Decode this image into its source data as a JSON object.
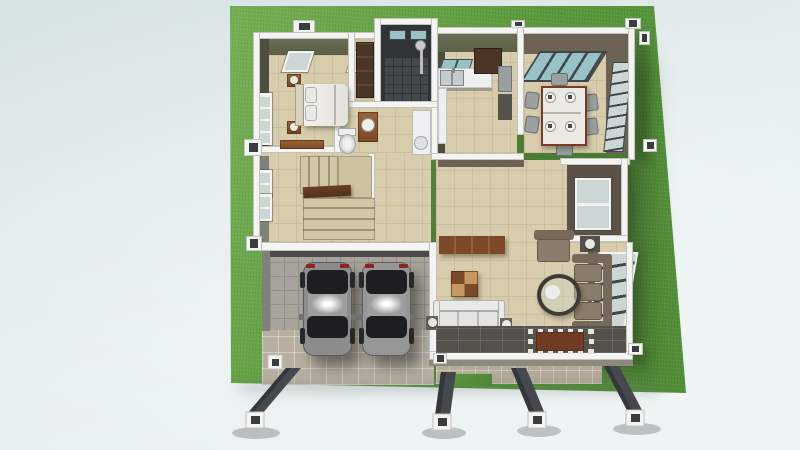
{
  "scene": {
    "type": "3d-floorplan-render",
    "view": "top-down",
    "rooms": [
      "master-bedroom",
      "walk-in-closet",
      "shower-room",
      "bathroom",
      "kitchen",
      "dining-room",
      "living-room",
      "hallway-stairs",
      "garage",
      "entry-terrace",
      "front-porch"
    ],
    "furniture": [
      "double-bed",
      "pillows",
      "headboard",
      "nightstand",
      "table-lamp",
      "bedroom-bench",
      "wardrobe",
      "toilet",
      "wood-vanity",
      "white-vanity",
      "kitchen-counter",
      "double-sink",
      "refrigerator",
      "wall-cabinet",
      "dining-table",
      "dining-chairs",
      "place-settings",
      "tv-console",
      "cubby-table",
      "white-loveseat",
      "armchair",
      "long-sofa",
      "round-coffee-table",
      "side-table",
      "floor-lamp",
      "staircase",
      "stair-railing",
      "rug"
    ],
    "vehicles": [
      "car-left",
      "car-right"
    ],
    "exterior": [
      "lawn",
      "driveway",
      "porch-columns",
      "window-bays",
      "wall-pillars"
    ]
  },
  "colors": {
    "bg1": "#d7e2e4",
    "bg2": "#e7efef",
    "bg3": "#edf3f3",
    "grass": "#5f9f41",
    "grass_dark": "#4c8a33",
    "grass_light": "#74b156",
    "wall_cap": "#f4f4f2",
    "wall_edge": "#c2c3be",
    "stub_dark": "#3a3e40",
    "face_olive": "#5d6049",
    "face_olive_dark": "#4c4f3d",
    "face_gray": "#80807a",
    "face_taupe": "#6c6355",
    "face_bath_dark": "#303436",
    "ext_face": "#8e887d",
    "floor_beige": "#d7ccab",
    "floor_dark": "#43484b",
    "floor_dark_line": "#2e3336",
    "garage_floor": "#a9a49b",
    "garage_line": "#938f87",
    "driveway": "#b8afa1",
    "porch_tile": "#b4aa98",
    "entry_dark": "#54504a",
    "rug": "#6f3b23",
    "accent_tile": "#e7e4dc",
    "glass_teal": "#97c2c6",
    "glass_pale": "#ccd6d5",
    "frame_dark": "#41464a",
    "frame_white": "#f2f3f2",
    "car_body": "#8c8c8c",
    "car_body2": "#969696",
    "car_glass": "#1c1e20",
    "car_wheel": "#26282a",
    "taillight": "#8c2420",
    "wood": "#7c4a28",
    "wood_dark": "#4a3526",
    "wood_light": "#c59a62",
    "sofa": "#8b7d6c",
    "sofa_dark": "#77695a",
    "fabric_white": "#e9e9e7",
    "counter": "#edeff0",
    "steel": "#c6cbce",
    "chair": "#9aa09f",
    "table_white": "#ebe9e4",
    "table_trim": "#7a3b2a",
    "stair": "#d2c8a5",
    "stair_edge": "#9d9376",
    "rail": "#53301d",
    "shadow": "rgba(25,40,20,0.35)",
    "pillar": "#45494e",
    "pillar_dark": "#33363b"
  }
}
